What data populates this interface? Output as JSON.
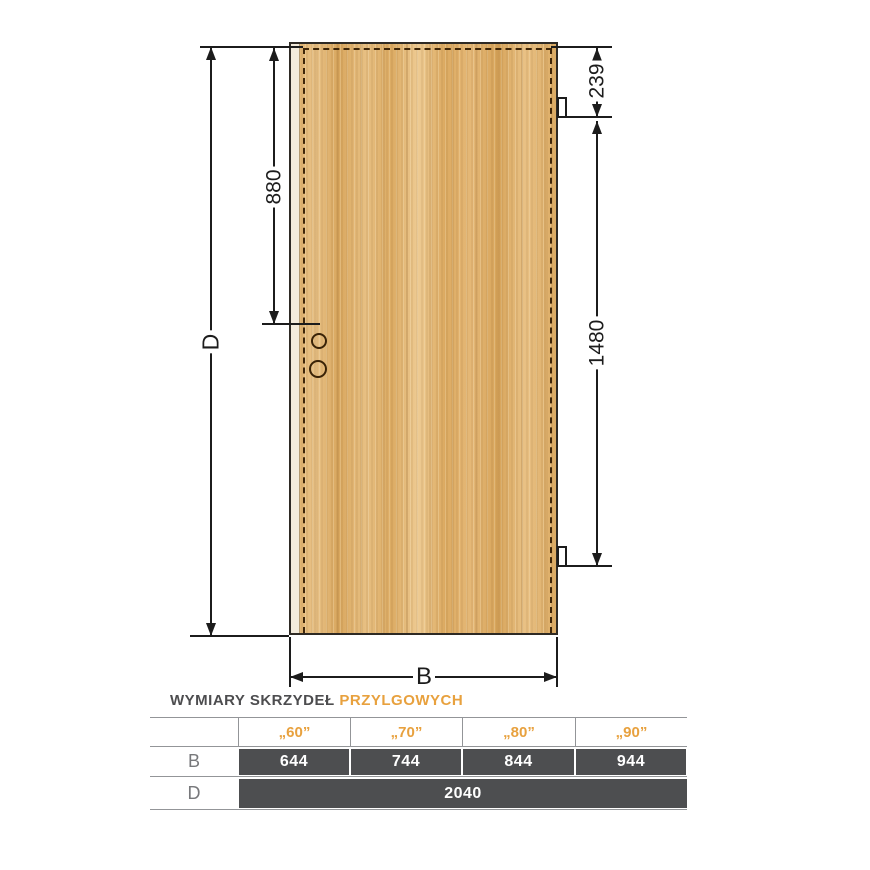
{
  "diagram": {
    "full_height_label": "D",
    "full_width_label": "B",
    "top_to_handle": "880",
    "top_to_top_hinge": "239",
    "hinge_to_hinge": "1480"
  },
  "table": {
    "title_main": "WYMIARY SKRZYDEŁ",
    "title_accent": "PRZYLGOWYCH",
    "size_headers": [
      "„60”",
      "„70”",
      "„80”",
      "„90”"
    ],
    "row_b_label": "B",
    "row_b_values": [
      "644",
      "744",
      "844",
      "944"
    ],
    "row_d_label": "D",
    "row_d_value": "2040"
  },
  "colors": {
    "accent_orange": "#E8A13E",
    "table_cell_dark": "#4D4E50",
    "table_border_gray": "#939598",
    "wood_base": "#E2B26C",
    "dash_brown": "#3F2609",
    "line_black": "#1C1C1C"
  }
}
